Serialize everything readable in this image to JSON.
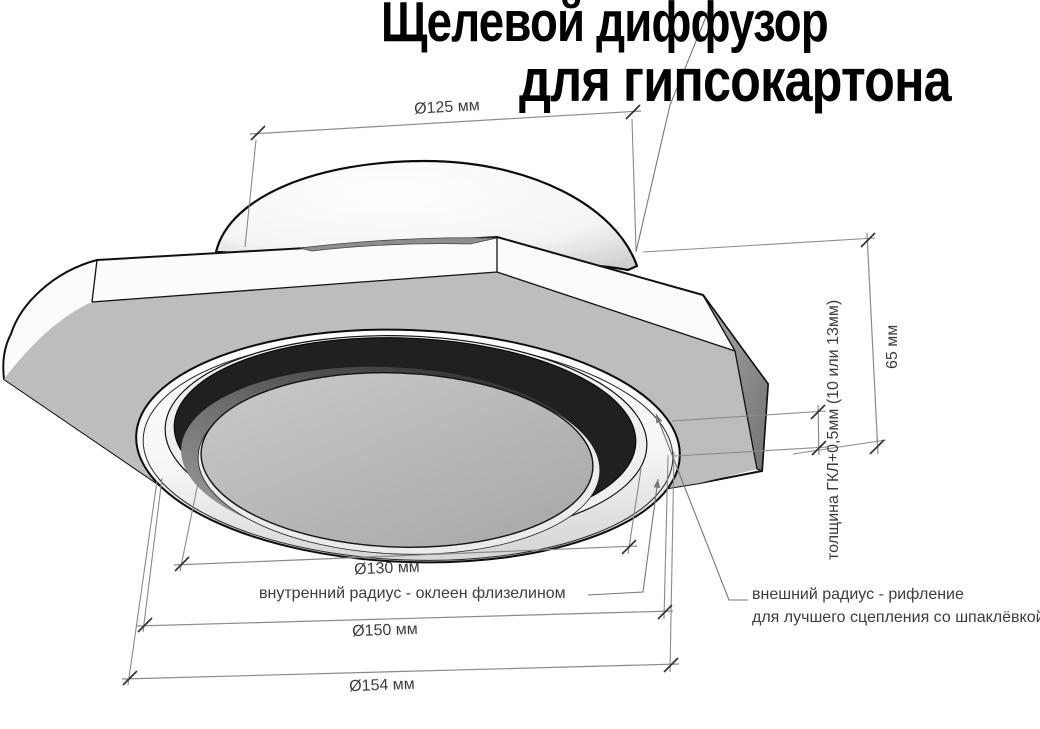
{
  "title": {
    "line1": "Щелевой диффузор",
    "line2": "для гипсокартона"
  },
  "dimensions": {
    "spigot_diameter": "Ø125 мм",
    "slot_inner_diameter": "Ø130 мм",
    "flange_step_diameter": "Ø150 мм",
    "flange_outer_diameter": "Ø154 мм",
    "total_height": "65 мм",
    "board_thickness": "толщина ГКЛ+0,5мм (10 или 13мм)"
  },
  "annotations": {
    "inner_radius_note": "внутренний радиус - оклеен флизелином",
    "outer_radius_note_line1": "внешний радиус - рифление",
    "outer_radius_note_line2": "для лучшего сцепления со шпаклёвкой"
  },
  "colors": {
    "background": "#ffffff",
    "outline": "#111111",
    "plate_bottom": "#bdbdbd",
    "plate_bevel_shadow": "#8d8d8d",
    "slot_ring": "#202020",
    "inner_disc": "#b5b5b5",
    "dimension_line": "#8a8a8a",
    "dimension_text": "#3d3d3d",
    "title_text": "#000000"
  }
}
